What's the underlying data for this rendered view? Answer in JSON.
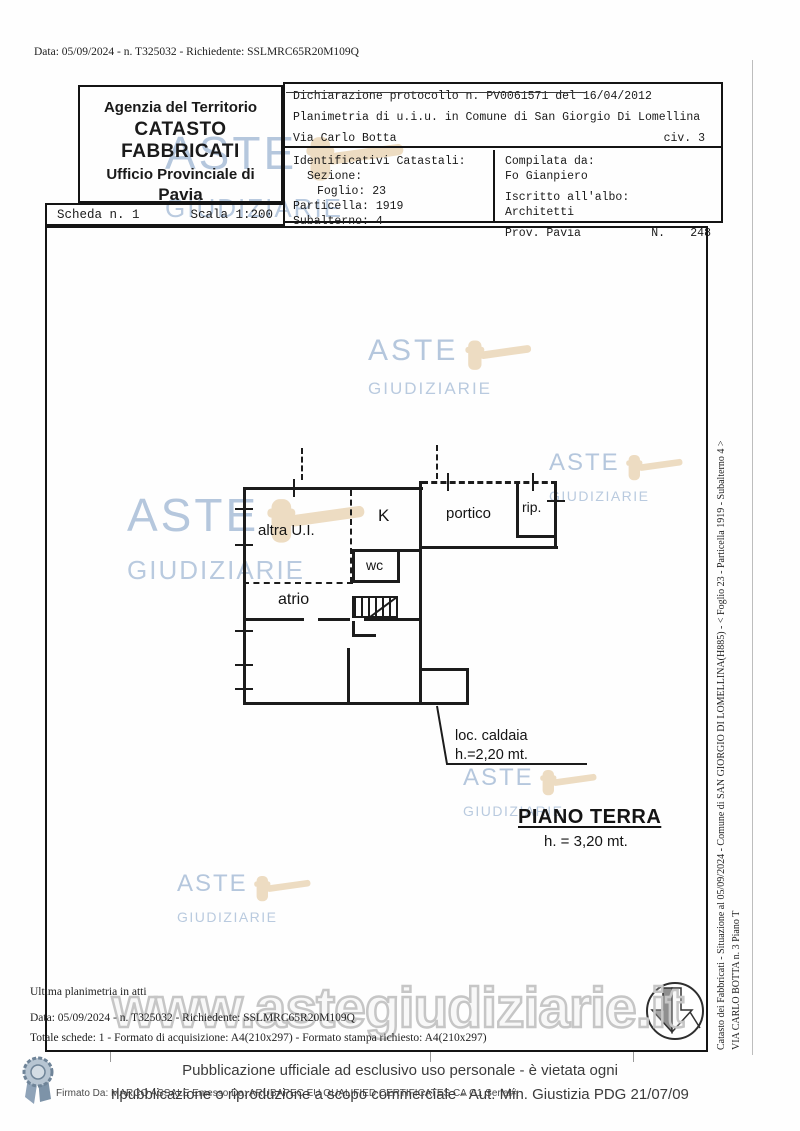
{
  "meta": {
    "top_line": "Data: 05/09/2024 - n. T325032 - Richiedente: SSLMRC65R20M109Q"
  },
  "header": {
    "agency": {
      "line1": "Agenzia del Territorio",
      "line2": "CATASTO FABBRICATI",
      "line3": "Ufficio Provinciale di",
      "line4": "Pavia"
    },
    "scheda": {
      "number": "Scheda n. 1",
      "scale": "Scala 1:200"
    },
    "declaration": {
      "protocol": "Dichiarazione protocollo n. PV0061571 del 16/04/2012",
      "planimetria": "Planimetria di u.i.u. in Comune di San Giorgio Di Lomellina",
      "street": "Via Carlo Botta",
      "civic": "civ. 3"
    },
    "catastali": {
      "title": "Identificativi Catastali:",
      "sezione": "Sezione:",
      "foglio": "Foglio: 23",
      "particella": "Particella: 1919",
      "subalterno": "Subalterno: 4"
    },
    "compilata": {
      "label": "Compilata da:",
      "name": "Fo Gianpiero",
      "albo_label": "Iscritto all'albo:",
      "albo": "Architetti",
      "prov": "Prov. Pavia",
      "n_label": "N.",
      "n_value": "248"
    }
  },
  "plan": {
    "rooms": {
      "altra_ui": "altra U.I.",
      "k": "K",
      "portico": "portico",
      "rip": "rip.",
      "wc": "wc",
      "atrio": "atrio"
    },
    "caldaia_line1": "loc. caldaia",
    "caldaia_line2": "h.=2,20 mt.",
    "floor_title": "PIANO TERRA",
    "floor_height": "h. = 3,20 mt."
  },
  "sidebar": {
    "line1": "Catasto dei Fabbricati - Situazione al 05/09/2024 - Comune di SAN GIORGIO DI LOMELLINA(H885) - < Foglio 23 - Particella 1919 - Subalterno 4 >",
    "line2": "VIA CARLO BOTTA n. 3 Piano T"
  },
  "watermark": {
    "aste": "ASTE",
    "giudiziarie": "GIUDIZIARIE",
    "url": "www.astegiudiziarie.it",
    "text_color": "#a9bed8",
    "gavel_color": "#ecd9bc",
    "url_outline_color": "#c6c6c6"
  },
  "bottom": {
    "line1": "Ultima planimetria in atti",
    "line2": "Data: 05/09/2024 - n. T325032 - Richiedente: SSLMRC65R20M109Q",
    "line3": "Totale schede: 1 - Formato di acquisizione: A4(210x297) - Formato stampa richiesto: A4(210x297)"
  },
  "footer": {
    "line1": "Pubblicazione ufficiale ad esclusivo uso personale - è vietata ogni",
    "line2": "ripubblicazione o riproduzione a scopo commerciale - Aut. Min. Giustizia PDG 21/07/09",
    "signature": "Firmato Da: MARCO ASSALE Emesso Da: ARUBAPEC EU QUALIFIED CERTIFICATES CA G1 Serial#:"
  }
}
